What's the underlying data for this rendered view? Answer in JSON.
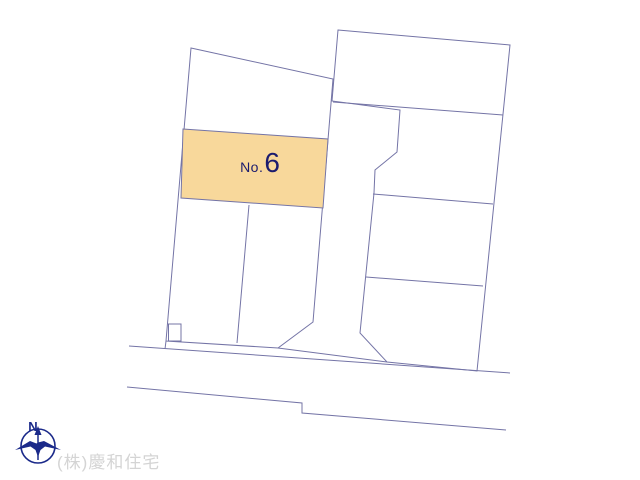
{
  "lot_label": {
    "prefix": "No.",
    "number": "6"
  },
  "compass": {
    "north_label": "N"
  },
  "footer": {
    "company": "(株)慶和住宅"
  },
  "colors": {
    "background": "#ffffff",
    "line": "#7474a6",
    "lot_fill": "#f8d89b",
    "lot_text": "#1c1c6e",
    "compass": "#1b2a8a",
    "company_text": "#d4d4d4"
  }
}
